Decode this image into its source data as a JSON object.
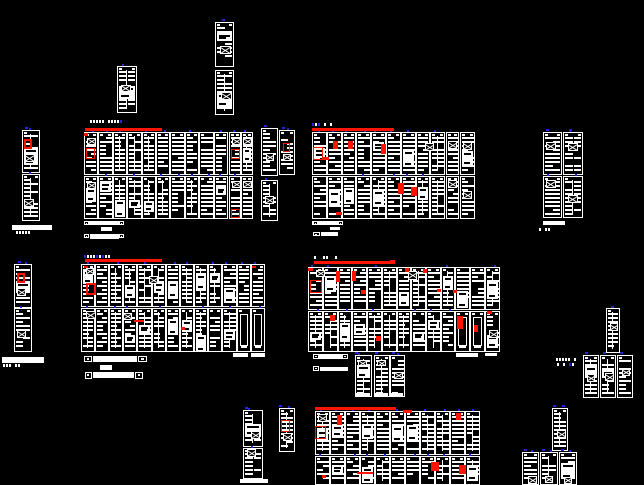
{
  "canvas": {
    "width": 644,
    "height": 485,
    "background": "#000000"
  },
  "colors": {
    "line": "#ffffff",
    "red": "#ff1400",
    "orange": "#ff5500",
    "blue": "#2424dd",
    "bg": "#000000"
  },
  "red_bars": [
    [
      85,
      128,
      77,
      3
    ],
    [
      312,
      128,
      82,
      3
    ],
    [
      85,
      259,
      77,
      3
    ],
    [
      314,
      261,
      81,
      3
    ],
    [
      315,
      407,
      81,
      3
    ]
  ],
  "clusters": [
    {
      "name": "switchgear-cluster-top-left",
      "cols": [
        [
          84,
          14
        ],
        [
          98,
          15
        ],
        [
          113,
          14
        ],
        [
          127,
          15
        ],
        [
          142,
          14
        ],
        [
          156,
          14
        ],
        [
          170,
          15
        ],
        [
          185,
          14
        ],
        [
          199,
          15
        ],
        [
          214,
          14
        ],
        [
          229,
          12
        ],
        [
          241,
          12
        ]
      ],
      "rows": [
        [
          132,
          43
        ],
        [
          176,
          43
        ]
      ],
      "sparse": []
    },
    {
      "name": "switchgear-cluster-top-right",
      "cols": [
        [
          312,
          15
        ],
        [
          327,
          15
        ],
        [
          342,
          14
        ],
        [
          356,
          15
        ],
        [
          371,
          15
        ],
        [
          386,
          15
        ],
        [
          401,
          15
        ],
        [
          416,
          14
        ],
        [
          430,
          15
        ],
        [
          446,
          13
        ],
        [
          460,
          15
        ]
      ],
      "rows": [
        [
          132,
          43
        ],
        [
          176,
          43
        ]
      ],
      "sparse": []
    },
    {
      "name": "switchgear-cluster-bottom-left",
      "cols": [
        [
          81,
          14
        ],
        [
          95,
          14
        ],
        [
          109,
          14
        ],
        [
          123,
          14
        ],
        [
          137,
          15
        ],
        [
          152,
          14
        ],
        [
          166,
          14
        ],
        [
          180,
          14
        ],
        [
          194,
          14
        ],
        [
          208,
          14
        ],
        [
          222,
          15
        ],
        [
          237,
          14
        ],
        [
          251,
          14
        ]
      ],
      "rows": [
        [
          264,
          43
        ],
        [
          308,
          44
        ]
      ],
      "sparse": [
        [
          1,
          11
        ],
        [
          1,
          12
        ]
      ]
    },
    {
      "name": "switchgear-cluster-bottom-right",
      "cols": [
        [
          308,
          15
        ],
        [
          323,
          15
        ],
        [
          338,
          14
        ],
        [
          352,
          15
        ],
        [
          367,
          15
        ],
        [
          382,
          15
        ],
        [
          397,
          14
        ],
        [
          411,
          15
        ],
        [
          426,
          15
        ],
        [
          441,
          14
        ],
        [
          455,
          15
        ],
        [
          470,
          15
        ],
        [
          485,
          15
        ]
      ],
      "rows": [
        [
          267,
          43
        ],
        [
          311,
          41
        ]
      ],
      "sparse": [
        [
          1,
          10
        ],
        [
          1,
          11
        ]
      ]
    },
    {
      "name": "switchgear-cluster-bottom-edge",
      "cols": [
        [
          315,
          15
        ],
        [
          330,
          15
        ],
        [
          345,
          15
        ],
        [
          360,
          15
        ],
        [
          375,
          15
        ],
        [
          390,
          15
        ],
        [
          405,
          15
        ],
        [
          420,
          15
        ],
        [
          435,
          15
        ],
        [
          450,
          15
        ],
        [
          465,
          15
        ]
      ],
      "rows": [
        [
          411,
          44
        ],
        [
          456,
          29
        ]
      ],
      "sparse": []
    }
  ],
  "cabinets": [
    [
      117,
      66,
      20,
      47
    ],
    [
      215,
      22,
      19,
      45
    ],
    [
      215,
      70,
      19,
      45
    ],
    [
      22,
      130,
      18,
      43
    ],
    [
      22,
      174,
      18,
      47
    ],
    [
      14,
      264,
      18,
      44
    ],
    [
      14,
      308,
      18,
      44
    ],
    [
      261,
      128,
      17,
      48
    ],
    [
      279,
      130,
      16,
      45
    ],
    [
      261,
      180,
      17,
      41
    ],
    [
      543,
      132,
      19,
      43
    ],
    [
      563,
      132,
      20,
      43
    ],
    [
      543,
      176,
      19,
      42
    ],
    [
      563,
      176,
      20,
      42
    ],
    [
      355,
      355,
      17,
      42
    ],
    [
      374,
      355,
      16,
      42
    ],
    [
      390,
      355,
      15,
      42
    ],
    [
      606,
      308,
      14,
      45
    ],
    [
      583,
      355,
      16,
      43
    ],
    [
      600,
      355,
      16,
      43
    ],
    [
      617,
      355,
      16,
      43
    ],
    [
      552,
      408,
      16,
      43
    ],
    [
      522,
      452,
      17,
      33
    ],
    [
      540,
      452,
      18,
      33
    ],
    [
      559,
      452,
      18,
      33
    ],
    [
      243,
      410,
      20,
      37
    ],
    [
      243,
      448,
      20,
      31
    ],
    [
      279,
      408,
      16,
      44
    ]
  ],
  "x_boxes": [
    [
      121,
      85,
      10,
      7
    ],
    [
      220,
      46,
      11,
      8
    ],
    [
      221,
      92,
      11,
      8
    ],
    [
      25,
      154,
      10,
      8
    ],
    [
      24,
      199,
      10,
      8
    ],
    [
      17,
      288,
      9,
      8
    ],
    [
      17,
      330,
      9,
      8
    ],
    [
      87,
      138,
      9,
      7
    ],
    [
      87,
      182,
      9,
      7
    ],
    [
      232,
      138,
      9,
      7
    ],
    [
      243,
      138,
      9,
      7
    ],
    [
      232,
      181,
      9,
      7
    ],
    [
      243,
      181,
      9,
      7
    ],
    [
      266,
      153,
      8,
      8
    ],
    [
      283,
      154,
      8,
      7
    ],
    [
      265,
      196,
      9,
      8
    ],
    [
      425,
      143,
      9,
      8
    ],
    [
      448,
      141,
      9,
      8
    ],
    [
      463,
      142,
      9,
      8
    ],
    [
      448,
      180,
      9,
      8
    ],
    [
      463,
      191,
      9,
      8
    ],
    [
      316,
      270,
      9,
      7
    ],
    [
      408,
      271,
      9,
      9
    ],
    [
      489,
      330,
      9,
      8
    ],
    [
      546,
      142,
      10,
      8
    ],
    [
      568,
      143,
      10,
      8
    ],
    [
      546,
      180,
      10,
      8
    ],
    [
      568,
      195,
      10,
      8
    ],
    [
      86,
      268,
      8,
      7
    ],
    [
      149,
      276,
      9,
      8
    ],
    [
      86,
      311,
      10,
      8
    ],
    [
      123,
      313,
      9,
      7
    ],
    [
      318,
      414,
      9,
      8
    ],
    [
      283,
      433,
      9,
      8
    ],
    [
      251,
      431,
      9,
      8
    ],
    [
      247,
      449,
      9,
      8
    ],
    [
      358,
      360,
      9,
      6
    ],
    [
      377,
      360,
      9,
      6
    ],
    [
      394,
      372,
      9,
      7
    ],
    [
      610,
      323,
      8,
      8
    ],
    [
      587,
      374,
      8,
      8
    ],
    [
      605,
      373,
      9,
      8
    ],
    [
      622,
      369,
      8,
      7
    ],
    [
      557,
      430,
      9,
      8
    ],
    [
      528,
      476,
      9,
      8
    ],
    [
      545,
      476,
      8,
      7
    ],
    [
      564,
      477,
      8,
      7
    ]
  ],
  "red_boxes": [
    [
      24,
      139,
      8,
      10,
      2
    ],
    [
      17,
      273,
      8,
      10,
      2
    ],
    [
      86,
      148,
      9,
      11,
      1
    ],
    [
      231,
      149,
      9,
      10,
      1
    ],
    [
      231,
      209,
      9,
      9,
      1
    ],
    [
      313,
      147,
      10,
      13,
      1
    ],
    [
      283,
      143,
      7,
      9,
      1
    ],
    [
      86,
      283,
      10,
      12,
      2
    ],
    [
      310,
      280,
      12,
      13,
      1
    ],
    [
      315,
      426,
      11,
      13,
      1
    ],
    [
      281,
      420,
      9,
      12,
      1
    ]
  ],
  "red_marks": [
    [
      333,
      141,
      5,
      8
    ],
    [
      348,
      141,
      5,
      8
    ],
    [
      381,
      144,
      5,
      10
    ],
    [
      322,
      157,
      7,
      3
    ],
    [
      398,
      183,
      6,
      11
    ],
    [
      411,
      187,
      6,
      9
    ],
    [
      336,
      212,
      6,
      3
    ],
    [
      336,
      271,
      4,
      11
    ],
    [
      352,
      271,
      4,
      10
    ],
    [
      361,
      290,
      5,
      4
    ],
    [
      405,
      268,
      4,
      4
    ],
    [
      423,
      269,
      4,
      4
    ],
    [
      437,
      289,
      4,
      3
    ],
    [
      453,
      290,
      4,
      3
    ],
    [
      308,
      268,
      5,
      3
    ],
    [
      390,
      260,
      5,
      3
    ],
    [
      84,
      133,
      4,
      3
    ],
    [
      84,
      266,
      4,
      2
    ],
    [
      252,
      266,
      4,
      2
    ],
    [
      134,
      320,
      10,
      2
    ],
    [
      181,
      327,
      4,
      3
    ],
    [
      330,
      315,
      5,
      6
    ],
    [
      376,
      336,
      5,
      5
    ],
    [
      457,
      316,
      6,
      13
    ],
    [
      474,
      325,
      4,
      7
    ],
    [
      487,
      311,
      5,
      3
    ],
    [
      403,
      410,
      9,
      3
    ],
    [
      456,
      413,
      5,
      7
    ],
    [
      337,
      415,
      5,
      10
    ],
    [
      431,
      462,
      8,
      9
    ],
    [
      459,
      465,
      7,
      9
    ],
    [
      357,
      472,
      16,
      2
    ],
    [
      322,
      475,
      4,
      3
    ]
  ],
  "strips": [
    [
      12,
      225,
      40,
      5
    ],
    [
      2,
      357,
      42,
      6
    ],
    [
      85,
      221,
      38,
      4
    ],
    [
      101,
      227,
      11,
      4
    ],
    [
      90,
      234,
      29,
      5
    ],
    [
      312,
      221,
      30,
      4
    ],
    [
      330,
      227,
      10,
      3
    ],
    [
      321,
      232,
      17,
      4
    ],
    [
      93,
      356,
      44,
      6
    ],
    [
      100,
      365,
      12,
      5
    ],
    [
      93,
      372,
      41,
      6
    ],
    [
      318,
      354,
      24,
      5
    ],
    [
      320,
      367,
      28,
      4
    ],
    [
      456,
      353,
      22,
      4
    ],
    [
      485,
      353,
      12,
      3
    ],
    [
      233,
      353,
      15,
      4
    ],
    [
      251,
      353,
      14,
      4
    ],
    [
      543,
      221,
      22,
      4
    ],
    [
      356,
      393,
      14,
      4
    ],
    [
      374,
      393,
      14,
      4
    ],
    [
      391,
      393,
      12,
      4
    ],
    [
      240,
      479,
      28,
      4
    ]
  ],
  "boxes": [
    [
      84,
      356,
      8,
      6
    ],
    [
      138,
      356,
      9,
      6
    ],
    [
      85,
      372,
      7,
      7
    ],
    [
      135,
      372,
      8,
      7
    ],
    [
      84,
      221,
      5,
      4
    ],
    [
      119,
      221,
      5,
      4
    ],
    [
      84,
      234,
      5,
      4
    ],
    [
      119,
      234,
      5,
      4
    ],
    [
      313,
      221,
      5,
      4
    ],
    [
      338,
      221,
      5,
      4
    ],
    [
      313,
      232,
      7,
      4
    ],
    [
      313,
      354,
      6,
      5
    ],
    [
      342,
      354,
      6,
      5
    ],
    [
      313,
      366,
      6,
      5
    ]
  ],
  "microtexts": [
    [
      13,
      231,
      20
    ],
    [
      3,
      364,
      17
    ],
    [
      536,
      228,
      20
    ],
    [
      556,
      358,
      20
    ],
    [
      557,
      363,
      16
    ],
    [
      90,
      120,
      33
    ],
    [
      312,
      123,
      20
    ],
    [
      84,
      255,
      25
    ],
    [
      314,
      256,
      22
    ]
  ],
  "blue_ticks": [
    [
      222,
      19
    ],
    [
      562,
      405
    ],
    [
      611,
      306
    ],
    [
      546,
      129
    ],
    [
      569,
      129
    ],
    [
      264,
      125
    ],
    [
      282,
      127
    ],
    [
      25,
      127
    ],
    [
      18,
      261
    ],
    [
      355,
      352
    ],
    [
      375,
      352
    ],
    [
      392,
      352
    ],
    [
      585,
      352
    ],
    [
      603,
      352
    ],
    [
      620,
      352
    ],
    [
      524,
      449
    ],
    [
      542,
      449
    ],
    [
      561,
      449
    ],
    [
      553,
      405
    ],
    [
      279,
      405
    ],
    [
      245,
      407
    ]
  ]
}
